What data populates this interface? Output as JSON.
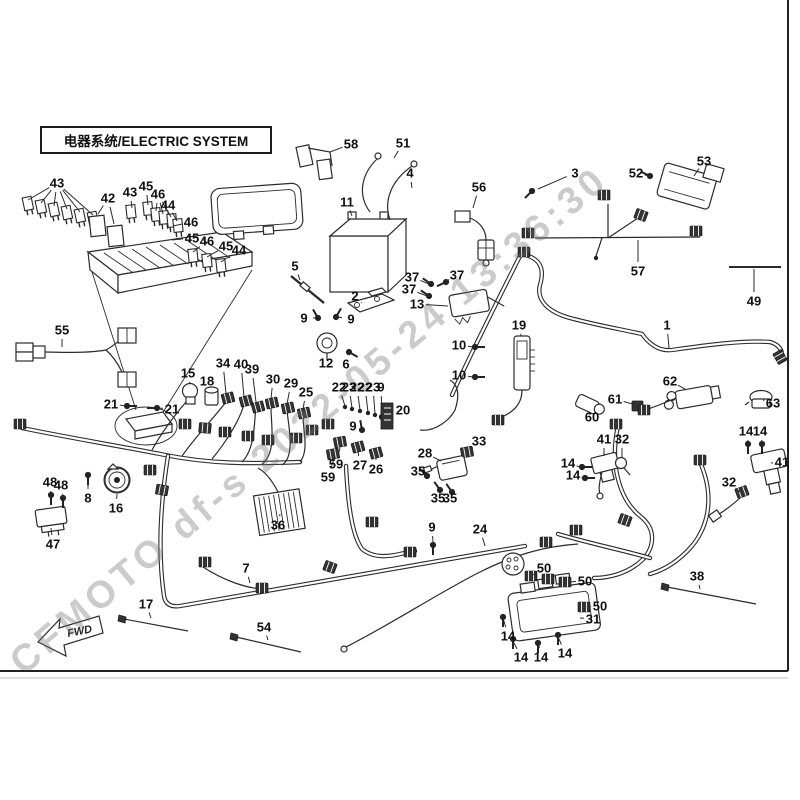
{
  "title": "电器系统/ELECTRIC SYSTEM",
  "watermark": "CFMOTO df-s 2022-05-24 13:36:30",
  "fwd_label": "FWD",
  "callouts": [
    {
      "label": "43",
      "x": 57,
      "y": 183,
      "targets": [
        [
          28,
          200
        ],
        [
          41,
          203
        ],
        [
          54,
          206
        ],
        [
          67,
          209
        ],
        [
          80,
          212
        ],
        [
          93,
          215
        ]
      ]
    },
    {
      "label": "42",
      "x": 108,
      "y": 198,
      "targets": [
        [
          98,
          214
        ],
        [
          114,
          224
        ]
      ]
    },
    {
      "label": "43",
      "x": 130,
      "y": 192,
      "targets": [
        [
          132,
          208
        ]
      ]
    },
    {
      "label": "45",
      "x": 146,
      "y": 186,
      "targets": [
        [
          148,
          205
        ]
      ]
    },
    {
      "label": "46",
      "x": 158,
      "y": 194,
      "targets": [
        [
          156,
          211
        ],
        [
          163,
          214
        ],
        [
          171,
          217
        ]
      ]
    },
    {
      "label": "44",
      "x": 168,
      "y": 205,
      "targets": [
        [
          177,
          221
        ]
      ]
    },
    {
      "label": "46",
      "x": 191,
      "y": 222,
      "targets": [
        [
          173,
          226
        ]
      ]
    },
    {
      "label": "45",
      "x": 192,
      "y": 238,
      "targets": [
        [
          172,
          240
        ]
      ]
    },
    {
      "label": "46",
      "x": 207,
      "y": 241,
      "targets": [
        [
          193,
          252
        ]
      ]
    },
    {
      "label": "45",
      "x": 226,
      "y": 246,
      "targets": [
        [
          207,
          257
        ]
      ]
    },
    {
      "label": "44",
      "x": 239,
      "y": 250,
      "targets": [
        [
          221,
          262
        ]
      ]
    },
    {
      "label": "5",
      "x": 295,
      "y": 266,
      "targets": [
        [
          300,
          280
        ]
      ]
    },
    {
      "label": "58",
      "x": 351,
      "y": 144,
      "targets": [
        [
          330,
          152
        ]
      ]
    },
    {
      "label": "51",
      "x": 403,
      "y": 143,
      "targets": [
        [
          394,
          158
        ]
      ]
    },
    {
      "label": "4",
      "x": 410,
      "y": 173,
      "targets": [
        [
          412,
          188
        ]
      ]
    },
    {
      "label": "11",
      "x": 347,
      "y": 202,
      "targets": [
        [
          352,
          216
        ]
      ]
    },
    {
      "label": "56",
      "x": 479,
      "y": 187,
      "targets": [
        [
          473,
          208
        ]
      ]
    },
    {
      "label": "3",
      "x": 575,
      "y": 173,
      "targets": [
        [
          538,
          189
        ]
      ]
    },
    {
      "label": "52",
      "x": 636,
      "y": 173,
      "targets": [
        [
          649,
          176
        ]
      ]
    },
    {
      "label": "53",
      "x": 704,
      "y": 161,
      "targets": [
        [
          694,
          176
        ]
      ]
    },
    {
      "label": "57",
      "x": 638,
      "y": 271,
      "targets": [
        [
          638,
          240
        ]
      ]
    },
    {
      "label": "49",
      "x": 754,
      "y": 301,
      "targets": [
        [
          754,
          269
        ]
      ]
    },
    {
      "label": "55",
      "x": 62,
      "y": 330,
      "targets": [
        [
          62,
          347
        ]
      ]
    },
    {
      "label": "21",
      "x": 111,
      "y": 404,
      "targets": [
        [
          126,
          406
        ]
      ]
    },
    {
      "label": "21",
      "x": 172,
      "y": 409,
      "targets": [
        [
          158,
          408
        ]
      ]
    },
    {
      "label": "2",
      "x": 355,
      "y": 296,
      "targets": [
        [
          362,
          303
        ]
      ]
    },
    {
      "label": "9",
      "x": 304,
      "y": 318,
      "targets": [
        [
          316,
          318
        ]
      ]
    },
    {
      "label": "9",
      "x": 351,
      "y": 319,
      "targets": [
        [
          338,
          317
        ]
      ]
    },
    {
      "label": "12",
      "x": 326,
      "y": 363,
      "targets": [
        [
          327,
          354
        ]
      ]
    },
    {
      "label": "6",
      "x": 346,
      "y": 364,
      "targets": [
        [
          348,
          354
        ]
      ]
    },
    {
      "label": "37",
      "x": 412,
      "y": 277,
      "targets": [
        [
          429,
          284
        ]
      ]
    },
    {
      "label": "37",
      "x": 457,
      "y": 275,
      "targets": [
        [
          445,
          282
        ]
      ]
    },
    {
      "label": "37",
      "x": 409,
      "y": 289,
      "targets": [
        [
          427,
          296
        ]
      ]
    },
    {
      "label": "13",
      "x": 417,
      "y": 304,
      "targets": [
        [
          448,
          306
        ]
      ]
    },
    {
      "label": "10",
      "x": 459,
      "y": 345,
      "targets": [
        [
          473,
          347
        ]
      ]
    },
    {
      "label": "10",
      "x": 459,
      "y": 375,
      "targets": [
        [
          473,
          377
        ]
      ]
    },
    {
      "label": "19",
      "x": 519,
      "y": 325,
      "targets": [
        [
          521,
          336
        ]
      ]
    },
    {
      "label": "15",
      "x": 188,
      "y": 373,
      "targets": [
        [
          190,
          384
        ]
      ]
    },
    {
      "label": "18",
      "x": 207,
      "y": 381,
      "targets": [
        [
          211,
          389
        ]
      ]
    },
    {
      "label": "34",
      "x": 223,
      "y": 363,
      "targets": [
        [
          226,
          394
        ]
      ]
    },
    {
      "label": "40",
      "x": 241,
      "y": 364,
      "targets": [
        [
          244,
          397
        ]
      ]
    },
    {
      "label": "39",
      "x": 252,
      "y": 369,
      "targets": [
        [
          256,
          402
        ]
      ]
    },
    {
      "label": "30",
      "x": 273,
      "y": 379,
      "targets": [
        [
          271,
          399
        ]
      ]
    },
    {
      "label": "29",
      "x": 291,
      "y": 383,
      "targets": [
        [
          287,
          404
        ]
      ]
    },
    {
      "label": "25",
      "x": 306,
      "y": 392,
      "targets": [
        [
          303,
          409
        ]
      ]
    },
    {
      "label": "22",
      "x": 339,
      "y": 387,
      "targets": [
        [
          345,
          406
        ]
      ]
    },
    {
      "label": "23",
      "x": 349,
      "y": 387,
      "targets": [
        [
          352,
          408
        ]
      ]
    },
    {
      "label": "22",
      "x": 357,
      "y": 387,
      "targets": [
        [
          360,
          410
        ]
      ]
    },
    {
      "label": "22",
      "x": 365,
      "y": 387,
      "targets": [
        [
          368,
          412
        ]
      ]
    },
    {
      "label": "23",
      "x": 373,
      "y": 387,
      "targets": [
        [
          375,
          414
        ]
      ]
    },
    {
      "label": "9",
      "x": 381,
      "y": 387,
      "targets": [
        [
          382,
          416
        ]
      ]
    },
    {
      "label": "20",
      "x": 403,
      "y": 410,
      "targets": [
        [
          394,
          412
        ]
      ]
    },
    {
      "label": "9",
      "x": 353,
      "y": 426,
      "targets": [
        [
          362,
          429
        ]
      ]
    },
    {
      "label": "59",
      "x": 336,
      "y": 464,
      "targets": [
        [
          340,
          448
        ]
      ]
    },
    {
      "label": "59",
      "x": 328,
      "y": 477,
      "targets": [
        [
          334,
          459
        ]
      ]
    },
    {
      "label": "27",
      "x": 360,
      "y": 465,
      "targets": [
        [
          358,
          452
        ]
      ]
    },
    {
      "label": "26",
      "x": 376,
      "y": 469,
      "targets": [
        [
          376,
          458
        ]
      ]
    },
    {
      "label": "36",
      "x": 278,
      "y": 525,
      "targets": [
        [
          280,
          514
        ]
      ]
    },
    {
      "label": "33",
      "x": 479,
      "y": 441,
      "targets": [
        [
          470,
          450
        ]
      ]
    },
    {
      "label": "28",
      "x": 425,
      "y": 453,
      "targets": [
        [
          441,
          461
        ]
      ]
    },
    {
      "label": "35",
      "x": 418,
      "y": 471,
      "targets": [
        [
          427,
          476
        ]
      ]
    },
    {
      "label": "35",
      "x": 438,
      "y": 498,
      "targets": [
        [
          440,
          491
        ]
      ]
    },
    {
      "label": "35",
      "x": 450,
      "y": 498,
      "targets": [
        [
          452,
          492
        ]
      ]
    },
    {
      "label": "9",
      "x": 432,
      "y": 527,
      "targets": [
        [
          433,
          542
        ]
      ]
    },
    {
      "label": "24",
      "x": 480,
      "y": 529,
      "targets": [
        [
          485,
          546
        ]
      ]
    },
    {
      "label": "60",
      "x": 592,
      "y": 417,
      "targets": [
        [
          588,
          409
        ]
      ]
    },
    {
      "label": "61",
      "x": 615,
      "y": 399,
      "targets": [
        [
          636,
          405
        ]
      ]
    },
    {
      "label": "62",
      "x": 670,
      "y": 381,
      "targets": [
        [
          685,
          389
        ]
      ]
    },
    {
      "label": "63",
      "x": 773,
      "y": 403,
      "targets": [
        [
          763,
          400
        ]
      ]
    },
    {
      "label": "1",
      "x": 667,
      "y": 325,
      "targets": [
        [
          669,
          348
        ]
      ]
    },
    {
      "label": "41",
      "x": 604,
      "y": 439,
      "targets": [
        [
          604,
          456
        ]
      ]
    },
    {
      "label": "32",
      "x": 622,
      "y": 439,
      "targets": [
        [
          622,
          458
        ]
      ]
    },
    {
      "label": "14",
      "x": 568,
      "y": 463,
      "targets": [
        [
          580,
          467
        ]
      ]
    },
    {
      "label": "14",
      "x": 573,
      "y": 475,
      "targets": [
        [
          583,
          478
        ]
      ]
    },
    {
      "label": "14",
      "x": 746,
      "y": 431,
      "targets": [
        [
          748,
          442
        ]
      ]
    },
    {
      "label": "14",
      "x": 760,
      "y": 431,
      "targets": [
        [
          762,
          442
        ]
      ]
    },
    {
      "label": "41",
      "x": 782,
      "y": 462,
      "targets": [
        [
          771,
          463
        ]
      ]
    },
    {
      "label": "32",
      "x": 729,
      "y": 482,
      "targets": [
        [
          740,
          492
        ]
      ]
    },
    {
      "label": "48",
      "x": 50,
      "y": 482,
      "targets": [
        [
          51,
          493
        ]
      ]
    },
    {
      "label": "48",
      "x": 61,
      "y": 485,
      "targets": [
        [
          63,
          496
        ]
      ]
    },
    {
      "label": "47",
      "x": 53,
      "y": 544,
      "targets": [
        [
          51,
          528
        ]
      ]
    },
    {
      "label": "8",
      "x": 88,
      "y": 498,
      "targets": [
        [
          88,
          481
        ]
      ]
    },
    {
      "label": "16",
      "x": 116,
      "y": 508,
      "targets": [
        [
          117,
          494
        ]
      ]
    },
    {
      "label": "17",
      "x": 146,
      "y": 604,
      "targets": [
        [
          151,
          618
        ]
      ]
    },
    {
      "label": "7",
      "x": 246,
      "y": 568,
      "targets": [
        [
          250,
          583
        ]
      ]
    },
    {
      "label": "54",
      "x": 264,
      "y": 627,
      "targets": [
        [
          268,
          640
        ]
      ]
    },
    {
      "label": "50",
      "x": 544,
      "y": 568,
      "targets": [
        [
          533,
          575
        ],
        [
          549,
          578
        ]
      ]
    },
    {
      "label": "50",
      "x": 585,
      "y": 581,
      "targets": [
        [
          569,
          582
        ]
      ]
    },
    {
      "label": "50",
      "x": 600,
      "y": 606,
      "targets": [
        [
          588,
          607
        ]
      ]
    },
    {
      "label": "31",
      "x": 593,
      "y": 619,
      "targets": [
        [
          580,
          618
        ]
      ]
    },
    {
      "label": "14",
      "x": 508,
      "y": 636,
      "targets": [
        [
          504,
          621
        ]
      ]
    },
    {
      "label": "14",
      "x": 521,
      "y": 657,
      "targets": [
        [
          514,
          643
        ]
      ]
    },
    {
      "label": "14",
      "x": 541,
      "y": 657,
      "targets": [
        [
          539,
          646
        ]
      ]
    },
    {
      "label": "14",
      "x": 565,
      "y": 653,
      "targets": [
        [
          559,
          639
        ]
      ]
    },
    {
      "label": "38",
      "x": 697,
      "y": 576,
      "targets": [
        [
          700,
          589
        ]
      ]
    }
  ]
}
